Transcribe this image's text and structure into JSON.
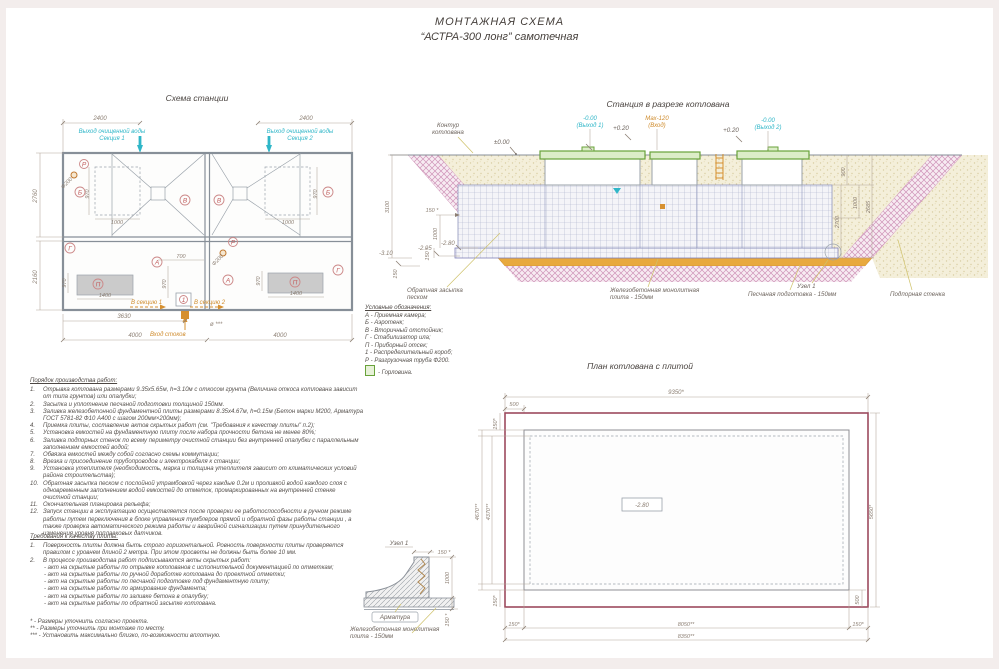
{
  "title": {
    "line1": "МОНТАЖНАЯ СХЕМА",
    "line2": "“АСТРА-300 лонг” самотечная"
  },
  "colors": {
    "accent_cyan": "#2fb6c8",
    "accent_orange": "#cf8c2e",
    "marker_red": "#c25d5d",
    "lid_green": "#68a23a",
    "slope_pink": "#cf93b8",
    "sand_layer_orange": "#e8a93e"
  },
  "plan": {
    "title": "Схема станции",
    "d2400": "2400",
    "d2760": "2760",
    "d2160": "2160",
    "d970": "970",
    "d1000": "1000",
    "d1400": "1400",
    "d700": "700",
    "d4000": "4000",
    "d3630": "3630",
    "d200": "Ф200",
    "dia": "ø ***",
    "out_l1": "Выход очищенной воды",
    "out1_l2": "Секция 1",
    "out2_l2": "Секция 2",
    "inlet": "Вход стоков",
    "sec1": "В секцию 1",
    "sec2": "В секцию 2",
    "mA": "А",
    "mB": "Б",
    "mV": "В",
    "mG": "Г",
    "mP": "П",
    "mR": "Р",
    "m1": "1"
  },
  "section": {
    "title": "Станция в разрезе котлована",
    "contour_l1": "Контур",
    "contour_l2": "котлована",
    "lvl0": "±0.00",
    "out1_a": "-0.00",
    "out1_b": "(Выход 1)",
    "p020": "+0.20",
    "max": "Мах-120",
    "vhod": "(Вход)",
    "out2_a": "-0.00",
    "out2_b": "(Выход 2)",
    "d900": "900",
    "d1000": "1000",
    "d2685": "2685",
    "d2700": "2700",
    "d3100": "3100",
    "m295": "-2.95",
    "m280": "-2.80",
    "m310": "-3.10",
    "d150": "150",
    "d150s": "150 *",
    "backfill_l1": "Обратная засыпка",
    "backfill_l2": "песком",
    "slab_l1": "Железобетонная монолитная",
    "slab_l2": "плита - 150мм",
    "node": "Узел 1",
    "sand": "Песчаная подготовка - 150мм",
    "wall": "Подпорная стенка"
  },
  "pitplan": {
    "title": "План котлована с плитой",
    "d9350": "9350*",
    "d500": "500",
    "d150": "150*",
    "d4670": "4670**",
    "d4370": "4370**",
    "d5650": "5650*",
    "lvl": "-2.80",
    "d8050": "8050**",
    "d8350": "8350**"
  },
  "node": {
    "title": "Узел 1",
    "d150": "150 *",
    "d1000": "1000",
    "rebar": "Арматура",
    "slab_l1": "Железобетонная монолитная",
    "slab_l2": "плита - 150мм"
  },
  "legend": {
    "title": "Условные обозначения:",
    "items": [
      "А - Приемная камера;",
      "Б - Аэротенк;",
      "В - Вторичный отстойник;",
      "Г - Стабилизатор ила;",
      "П - Приборный отсек;",
      "1 - Распределительный короб;",
      "Р - Разгрузочная труба Ф200."
    ],
    "gorlovina": "- Горловина."
  },
  "procedure": {
    "title": "Порядок производства работ:",
    "steps": [
      {
        "n": "1.",
        "t": "Отрывка котлована размерами 9.35х5.65м, h=3.10м с откосом грунта (Величина откоса котлована зависит от типа грунтов) или опалубки;"
      },
      {
        "n": "2.",
        "t": "Засыпка и уплотнение песчаной подготовки толщиной 150мм."
      },
      {
        "n": "3.",
        "t": "Заливка железобетонной фундаментной плиты размерами 8.35х4.67м, h=0.15м (Бетон марки М200, Арматура ГОСТ 5781-82 Ф10 А400 с шагом 200мм×200мм);"
      },
      {
        "n": "4.",
        "t": "Приемка плиты, составление актов скрытых работ (см. \"Требования к качеству плиты\" п.2);"
      },
      {
        "n": "5.",
        "t": "Установка емкостей на фундаментную плиту после набора прочности бетона не менее 80%;"
      },
      {
        "n": "6.",
        "t": "Заливка подпорных стенок по всему периметру очистной станции без внутренней опалубки с параллельным заполнением емкостей водой;"
      },
      {
        "n": "7.",
        "t": "Обвязка емкостей между собой согласно схемы коммутации;"
      },
      {
        "n": "8.",
        "t": "Врезка и присоединение трубопроводов и электрокабеля к станции;"
      },
      {
        "n": "9.",
        "t": "Установка утеплителя (необходимость, марка и толщина утеплителя зависит от климатических условий района строительства);"
      },
      {
        "n": "10.",
        "t": "Обратная засыпка песком с послойной утрамбовкой через каждые 0.2м и проливкой водой каждого слоя с одновременным заполнением водой емкостей до отметок, промаркированных на внутренней стенке очистной станции;"
      },
      {
        "n": "11.",
        "t": "Окончательная планировка рельефа;"
      },
      {
        "n": "12.",
        "t": "Запуск станции в эксплуатацию осуществляется после проверки ее работоспособности в ручном режиме работы путем переключения в блоке управления тумблеров прямой и обратной фазы работы станции , а также проверка автоматического режима работы и аварийной сигнализации путем принудительного изменения уровня поплавковых датчиков."
      }
    ]
  },
  "quality": {
    "title": "Требования к качеству плиты:",
    "item1n": "1.",
    "item1": "Поверхность плиты должна быть строго горизонтальной. Ровность поверхности плиты проверяется правилом с уровнем длиной 2 метра. При этом просветы не должны быть более 10 мм.",
    "item2n": "2.",
    "item2": "В процессе производства работ подписываются акты скрытых работ:",
    "bullets": [
      "- акт на скрытые работы по отрывке котлованов с исполнительной документацией по отметкам;",
      "- акт на скрытые работы по ручной доработке котлована до проектной отметки;",
      "- акт на скрытые работы по песчаной подготовке под фундаментную плиту;",
      "- акт на скрытые работы по армирование фундамента;",
      "- акт на скрытые работы по заливке бетона в опалубку;",
      "- акт на скрытые работы по обратной засыпке котлована."
    ]
  },
  "footnotes": [
    "* - Размеры уточнить согласно проекта.",
    "** - Размеры уточнить при монтаже по месту.",
    "*** - Установить максимально близко, по-возможности вплотную."
  ]
}
